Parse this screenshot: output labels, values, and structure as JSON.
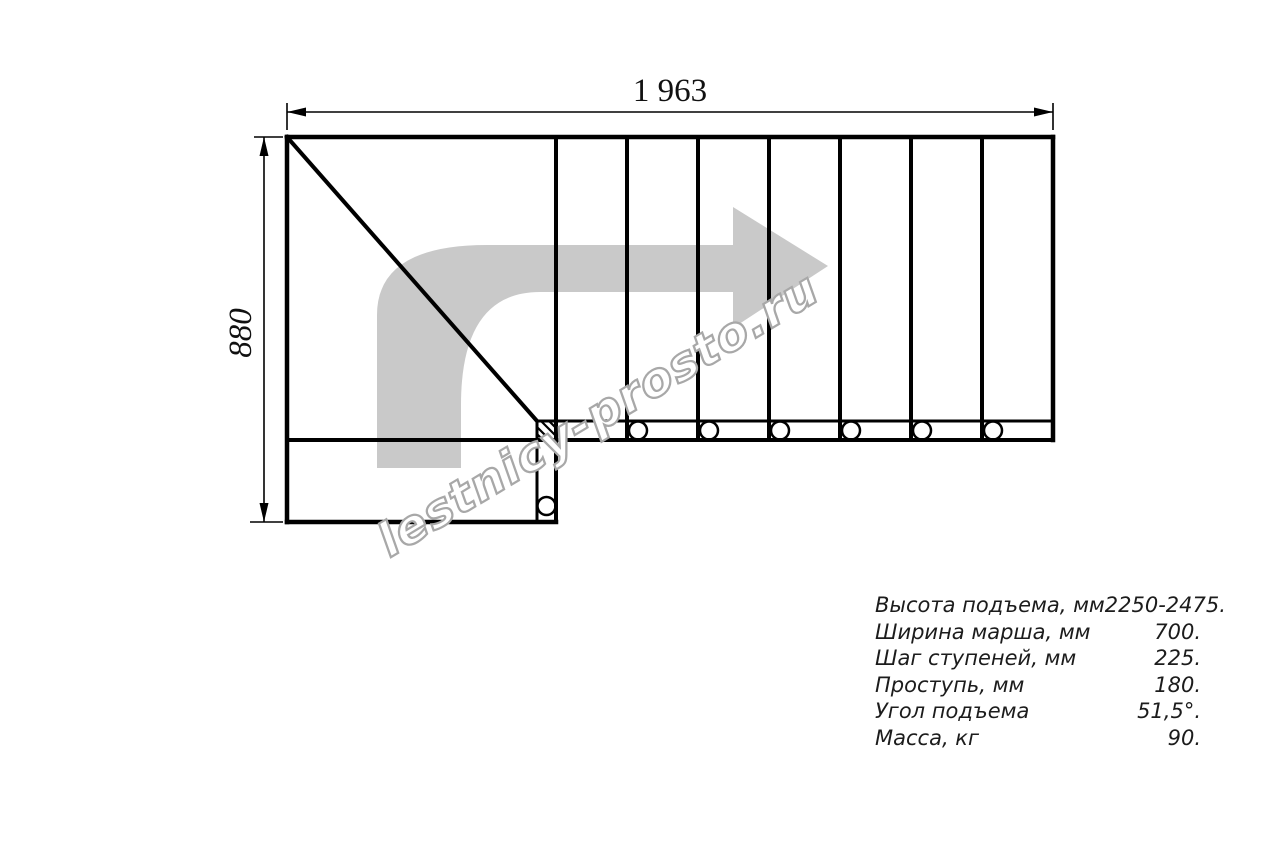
{
  "drawing": {
    "width_dimension": "1 963",
    "depth_dimension": "880",
    "watermark": "lestnicy-prosto.ru"
  },
  "specs": {
    "rows": [
      {
        "label": "Высота подъема, мм",
        "value": "2250-2475."
      },
      {
        "label": "Ширина марша, мм",
        "value": "700."
      },
      {
        "label": "Шаг ступеней, мм",
        "value": "225."
      },
      {
        "label": "Проступь, мм",
        "value": "180."
      },
      {
        "label": "Угол подъема",
        "value": "51,5°."
      },
      {
        "label": "Масса, кг",
        "value": "90."
      }
    ]
  },
  "colors": {
    "background": "#ffffff",
    "drawing_lines": "#000000",
    "direction_arrow": "#c9c9c9",
    "watermark_outline": "#a8a8a8",
    "text": "#1c1c1c"
  }
}
